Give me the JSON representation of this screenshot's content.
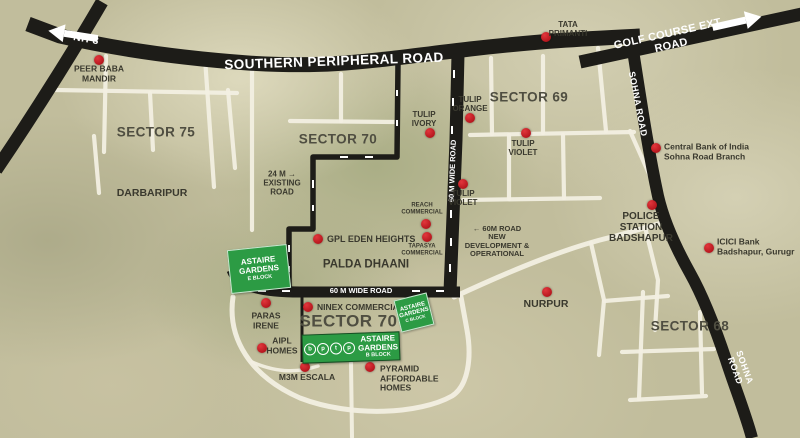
{
  "colors": {
    "terrain": "#c1bd9c",
    "road_black": "#1d1c18",
    "road_white": "#f2efe2",
    "astaire_green": "#2c9b44",
    "marker_red": "#b3151c",
    "label_dark": "#3a392e",
    "label_white": "#ffffff"
  },
  "markers": [
    {
      "name": "spr-road-label",
      "text": "SOUTHERN PERIPHERAL ROAD",
      "x": 334,
      "y": 61,
      "size": 13.5,
      "color": "white",
      "rotate": -2,
      "spacing": 0.4
    },
    {
      "name": "nh8-label",
      "text": "NH 8",
      "x": 86,
      "y": 40,
      "size": 10.5,
      "color": "white",
      "rotate": 10,
      "spacing": 0.5
    },
    {
      "name": "golf-course-ext-road-label",
      "text": "GOLF COURSE EXT. ROAD",
      "x": 670,
      "y": 40,
      "size": 11,
      "color": "white",
      "rotate": -12.5,
      "spacing": 0.3
    },
    {
      "name": "sohna-road-label-upper",
      "text": "SOHNA ROAD",
      "x": 638,
      "y": 104,
      "size": 9,
      "color": "white",
      "rotate": 79,
      "spacing": 0.5
    },
    {
      "name": "sohna-road-label-lower",
      "text": "SOHNA ROAD",
      "x": 740,
      "y": 369,
      "size": 9,
      "color": "white",
      "rotate": 70,
      "spacing": 0.5
    },
    {
      "name": "60m-wide-road-vertical-label",
      "text": "60 M WIDE ROAD",
      "x": 453,
      "y": 171,
      "size": 7.5,
      "color": "white",
      "rotate": -88
    },
    {
      "name": "60m-wide-road-horizontal-label",
      "text": "60 M WIDE ROAD",
      "x": 361,
      "y": 291,
      "size": 7.5,
      "color": "white"
    },
    {
      "name": "sector-75-label",
      "text": "SECTOR 75",
      "x": 156,
      "y": 132,
      "size": 13.5,
      "color": "sector"
    },
    {
      "name": "sector-70-label",
      "text": "SECTOR 70",
      "x": 338,
      "y": 139,
      "size": 13.5,
      "color": "sector"
    },
    {
      "name": "sector-69-label",
      "text": "SECTOR 69",
      "x": 529,
      "y": 97,
      "size": 13.5,
      "color": "sector"
    },
    {
      "name": "sector-68-label",
      "text": "SECTOR 68",
      "x": 690,
      "y": 326,
      "size": 13.5,
      "color": "sector"
    },
    {
      "name": "sector-70a-label",
      "text": "SECTOR 70 A",
      "x": 357,
      "y": 321,
      "size": 17,
      "color": "sector"
    },
    {
      "name": "peer-baba-mandir",
      "text": "PEER BABA\nMANDIR",
      "x": 99,
      "y": 74,
      "size": 8.5,
      "dot": [
        99,
        60
      ]
    },
    {
      "name": "darbaripur-label",
      "text": "DARBARIPUR",
      "x": 152,
      "y": 194,
      "size": 10.5
    },
    {
      "name": "tata-primanti",
      "text": "TATA\nPRIMANTI",
      "x": 568,
      "y": 30,
      "size": 8,
      "dot": [
        546,
        37
      ]
    },
    {
      "name": "tulip-ivory",
      "text": "TULIP\nIVORY",
      "x": 424,
      "y": 120,
      "size": 8,
      "dot": [
        430,
        133
      ]
    },
    {
      "name": "tulip-orange",
      "text": "TULIP\nORANGE",
      "x": 470,
      "y": 105,
      "size": 8,
      "dot": [
        470,
        118
      ]
    },
    {
      "name": "tulip-violet-upper",
      "text": "TULIP\nVIOLET",
      "x": 523,
      "y": 149,
      "size": 8,
      "dot": [
        526,
        133
      ]
    },
    {
      "name": "tulip-violet-lower",
      "text": "TULIP\nVIOLET",
      "x": 463,
      "y": 199,
      "size": 8,
      "dot": [
        463,
        184
      ]
    },
    {
      "name": "reach-commercial",
      "text": "REACH\nCOMMERCIAL",
      "x": 422,
      "y": 209,
      "size": 6,
      "dot": [
        426,
        224
      ]
    },
    {
      "name": "tapasya-commercial",
      "text": "TAPASYA\nCOMMERCIAL",
      "x": 422,
      "y": 250,
      "size": 6,
      "dot": [
        427,
        237
      ]
    },
    {
      "name": "gpl-eden-heights",
      "text": "GPL EDEN HEIGHTS",
      "x": 327,
      "y": 239,
      "size": 9,
      "anchor": "left",
      "dot": [
        318,
        239
      ]
    },
    {
      "name": "palda-dhaani-label",
      "text": "PALDA DHAANI",
      "x": 366,
      "y": 265,
      "size": 11.5
    },
    {
      "name": "24m-existing-road-label",
      "text": "24 M →\nEXISTING\nROAD",
      "x": 282,
      "y": 184,
      "size": 8
    },
    {
      "name": "60m-road-new-dev-label",
      "text": "← 60M ROAD\nNEW\nDEVELOPMENT &\nOPERATIONAL",
      "x": 497,
      "y": 242,
      "size": 7.5
    },
    {
      "name": "central-bank-sohna-branch",
      "text": "Central Bank of India\nSohna Road Branch",
      "x": 664,
      "y": 152,
      "size": 8.5,
      "anchor": "left",
      "dot": [
        656,
        148
      ]
    },
    {
      "name": "police-station-badshapur",
      "text": "POLICE\nSTATION\nBADSHAPUR",
      "x": 641,
      "y": 228,
      "size": 10,
      "dot": [
        652,
        205
      ]
    },
    {
      "name": "icici-bank-badshapur",
      "text": "ICICI Bank\nBadshapur, Gurugr",
      "x": 717,
      "y": 247,
      "size": 8.5,
      "anchor": "left",
      "dot": [
        709,
        248
      ]
    },
    {
      "name": "nurpur-label",
      "text": "NURPUR",
      "x": 546,
      "y": 305,
      "size": 10.5,
      "dot": [
        547,
        292
      ]
    },
    {
      "name": "paras-irene",
      "text": "PARAS\nIRENE",
      "x": 266,
      "y": 321,
      "size": 8.5,
      "dot": [
        266,
        303
      ]
    },
    {
      "name": "ninex-commercial",
      "text": "NINEX COMMERCIAL",
      "x": 317,
      "y": 308,
      "size": 8.5,
      "anchor": "left",
      "dot": [
        308,
        307
      ]
    },
    {
      "name": "aipl-homes",
      "text": "AIPL\nHOMES",
      "x": 282,
      "y": 346,
      "size": 8.5,
      "dot": [
        262,
        348
      ]
    },
    {
      "name": "m3m-escala",
      "text": "M3M ESCALA",
      "x": 307,
      "y": 378,
      "size": 8.5,
      "dot": [
        305,
        367
      ]
    },
    {
      "name": "pyramid-affordable-homes",
      "text": "PYRAMID\nAFFORDABLE\nHOMES",
      "x": 380,
      "y": 379,
      "size": 8.5,
      "anchor": "left",
      "dot": [
        370,
        367
      ]
    }
  ],
  "blocks": {
    "e": {
      "name": "ASTAIRE\nGARDENS",
      "block": "E BLOCK"
    },
    "c": {
      "name": "ASTAIRE\nGARDENS",
      "block": "C BLOCK"
    },
    "b": {
      "name": "ASTAIRE\nGARDENS",
      "block": "B BLOCK",
      "logo": [
        "b",
        "p",
        "t",
        "p"
      ]
    }
  }
}
